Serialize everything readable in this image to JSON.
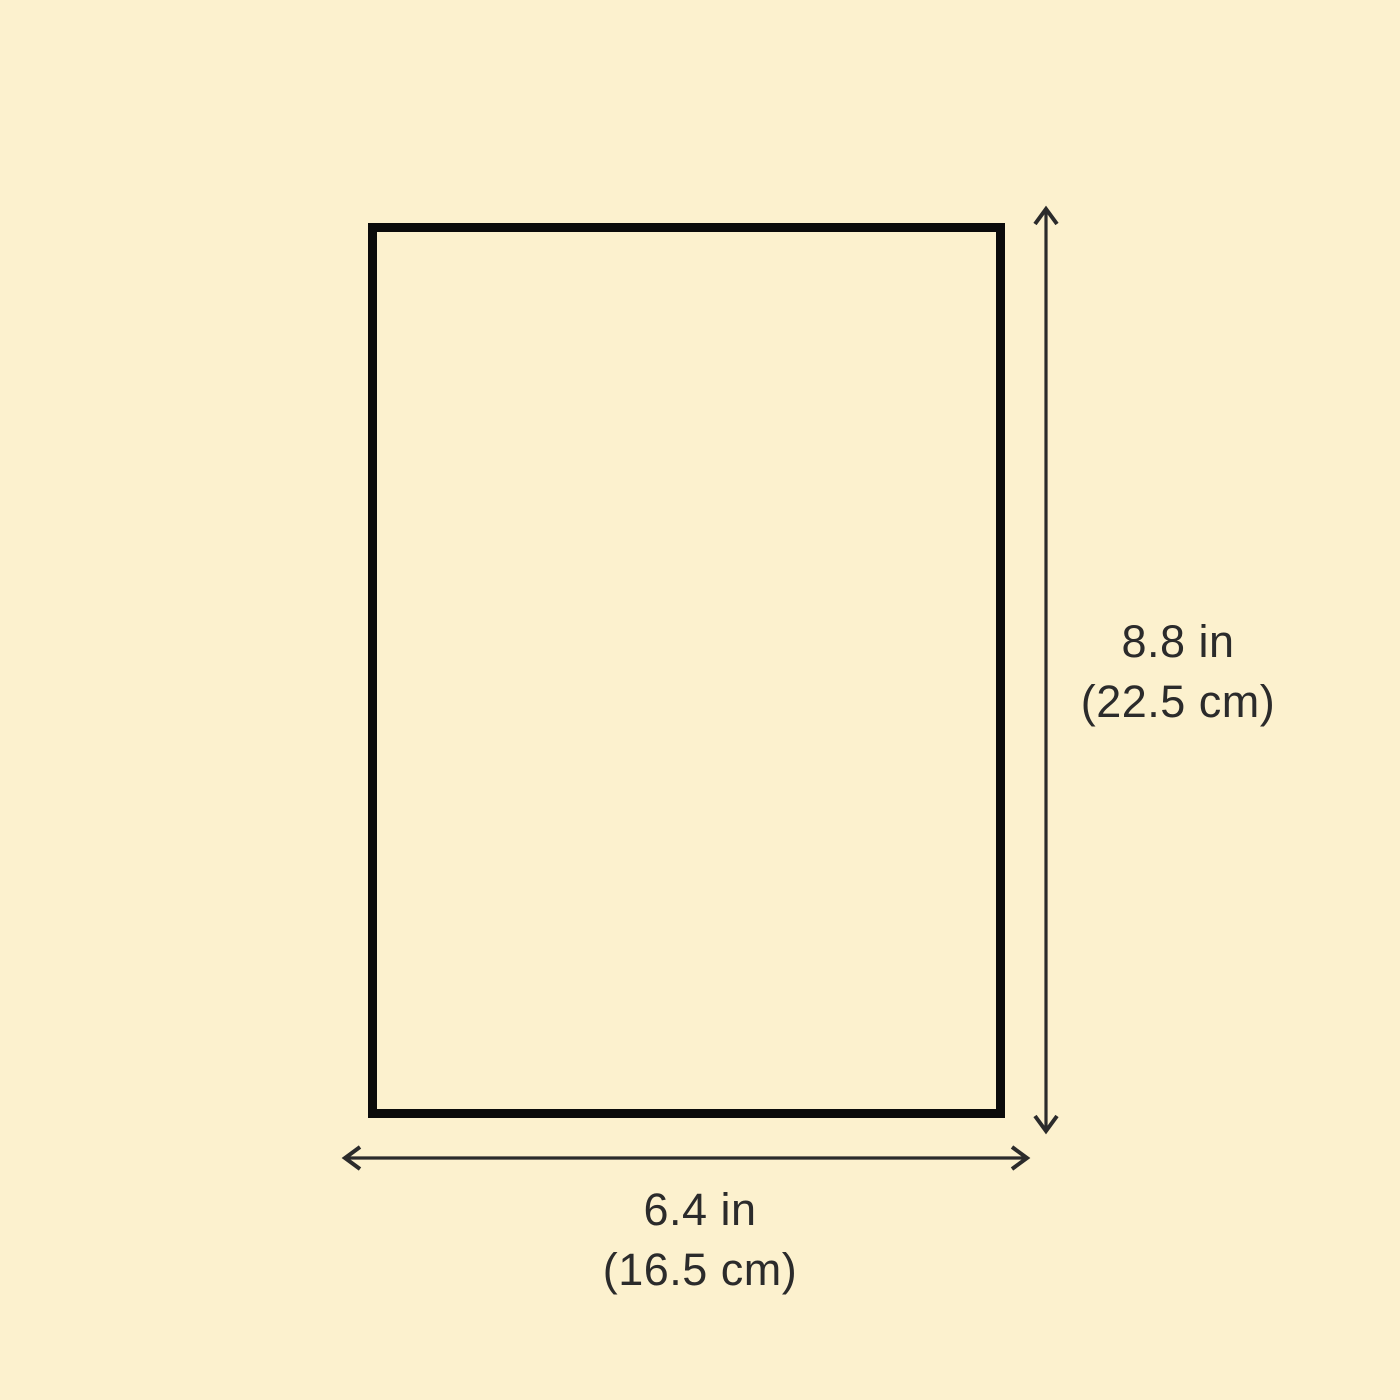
{
  "diagram": {
    "background_color": "#FCF1CE",
    "rectangle_border_color": "#0B0B0B",
    "arrow_color": "#2B2B2B",
    "text_color": "#2B2B2B",
    "height_dimension": {
      "inches": "8.8 in",
      "centimeters": "(22.5 cm)"
    },
    "width_dimension": {
      "inches": "6.4 in",
      "centimeters": "(16.5 cm)"
    }
  }
}
